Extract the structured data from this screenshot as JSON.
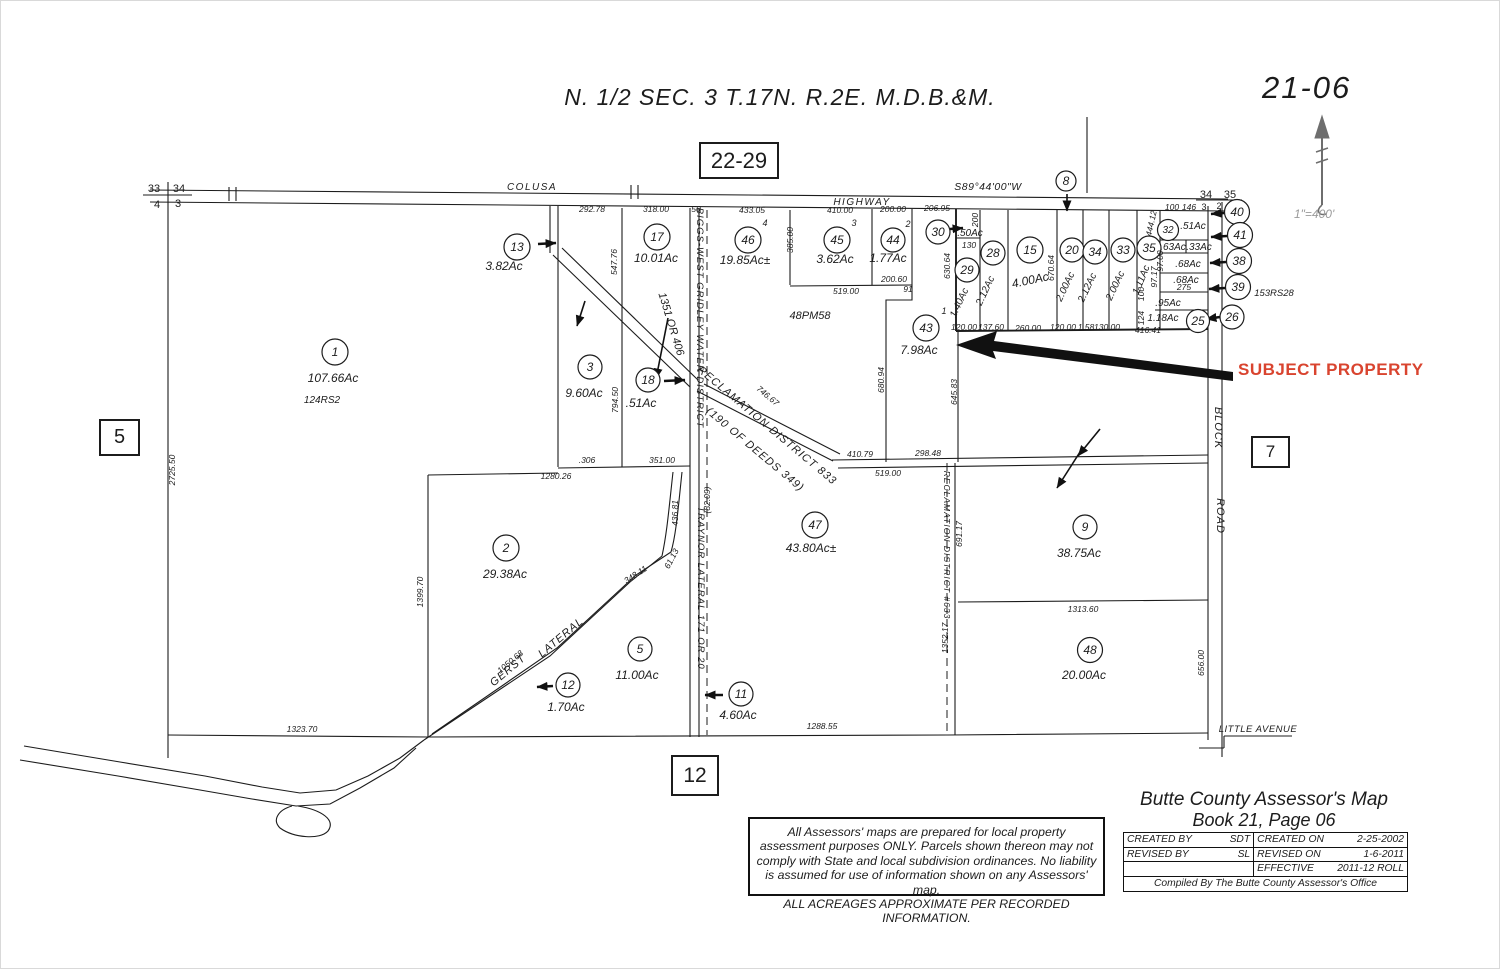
{
  "sheet": {
    "number": "21-06",
    "title": "N. 1/2 SEC. 3 T.17N. R.2E. M.D.B.&M.",
    "scale": "1\"=400'",
    "ref_top": "22-29",
    "ref_left": "5",
    "ref_right": "7",
    "ref_bottom": "12"
  },
  "corners": {
    "tl_a": "33",
    "tl_b": "34",
    "tl_c": "4",
    "tl_d": "3",
    "tr_a": "34",
    "tr_b": "35",
    "tr_c": "3",
    "tr_d": "2"
  },
  "roads": {
    "colusa": "COLUSA",
    "highway": "HIGHWAY",
    "bearing": "S89°44'00\"W",
    "marker_8": "8",
    "block": "BLOCK",
    "road": "ROAD",
    "little_avenue": "LITTLE AVENUE"
  },
  "waterways": {
    "biggs": "BIGGS-WEST GRIDLEY WATER DISTRICT",
    "biggs_ref": "1351 OR 406",
    "rd833": "RECLAMATION DISTRICT 833",
    "rd833_ref": "(190 OF DEEDS 349)",
    "traynor": "TRAYNOR LATERAL 171 OR 20",
    "rd633": "RECLAMATION DISTRICT #633",
    "gerst_1": "GERST",
    "gerst_2": "LATERAL"
  },
  "subject": {
    "label": "SUBJECT PROPERTY",
    "color": "#d9442f",
    "parcel": "43"
  },
  "notes": {
    "rs124": "124RS2",
    "pm48": "48PM58",
    "rs153": "153RS28"
  },
  "parcels": {
    "p1": {
      "num": "1",
      "ac": "107.66Ac"
    },
    "p2": {
      "num": "2",
      "ac": "29.38Ac"
    },
    "p3": {
      "num": "3",
      "ac": "9.60Ac"
    },
    "p5": {
      "num": "5",
      "ac": "11.00Ac"
    },
    "p9": {
      "num": "9",
      "ac": "38.75Ac"
    },
    "p11": {
      "num": "11",
      "ac": "4.60Ac"
    },
    "p12": {
      "num": "12",
      "ac": "1.70Ac"
    },
    "p13": {
      "num": "13",
      "ac": "3.82Ac"
    },
    "p15": {
      "num": "15",
      "ac": "4.00Ac"
    },
    "p17": {
      "num": "17",
      "ac": "10.01Ac"
    },
    "p18": {
      "num": "18",
      "ac": ".51Ac"
    },
    "p20": {
      "num": "20",
      "ac": "2.00Ac"
    },
    "p25": {
      "num": "25",
      "ac": "1.18Ac"
    },
    "p26": {
      "num": "26",
      "ac": ".95Ac"
    },
    "p28": {
      "num": "28",
      "ac": "2.12Ac"
    },
    "p29": {
      "num": "29",
      "ac": "1.40Ac"
    },
    "p30": {
      "num": "30",
      "ac": ".50Ac"
    },
    "p32": {
      "num": "32",
      "ac": ".51Ac"
    },
    "p33": {
      "num": "33",
      "ac": "2.00Ac"
    },
    "p34": {
      "num": "34",
      "ac": "2.12Ac"
    },
    "p35": {
      "num": "35",
      "ac": "1.11Ac"
    },
    "p38": {
      "num": "38"
    },
    "p39": {
      "num": "39"
    },
    "p40": {
      "num": "40"
    },
    "p41": {
      "num": "41"
    },
    "p43": {
      "num": "43",
      "ac": "7.98Ac",
      "lot": "1"
    },
    "p44": {
      "num": "44",
      "ac": "1.77Ac",
      "lot": "2"
    },
    "p45": {
      "num": "45",
      "ac": "3.62Ac",
      "lot": "3"
    },
    "p46": {
      "num": "46",
      "ac": "19.85Ac±",
      "lot": "4"
    },
    "p47": {
      "num": "47",
      "ac": "43.80Ac±"
    },
    "p48": {
      "num": "48",
      "ac": "20.00Ac"
    }
  },
  "extra_acreages": {
    "a63": ".63Ac",
    "a33": ".33Ac",
    "a68a": ".68Ac",
    "a68b": ".68Ac"
  },
  "dims": [
    "292.78",
    "318.00",
    "50",
    "433.05",
    "410.00",
    "200.00",
    "206.95",
    "547.76",
    "794.50",
    ".306",
    "351.00",
    "1280.26",
    "2725.50",
    "1399.70",
    "1323.70",
    "1288.55",
    "1050.68",
    "348.11",
    "61.13",
    "436.81",
    "(82.09)",
    "746.67",
    "410.79",
    "298.48",
    "519.00",
    "385.00",
    "519.00",
    "200.60",
    "91",
    "680.94",
    "645.83",
    "630.64",
    "670.64",
    "200",
    "130",
    "444.12",
    "100",
    "146",
    "97.17",
    "97.00",
    "100",
    "124",
    "120.00",
    "137.60",
    "260.00",
    "120.00",
    "1.58",
    "130.00",
    "416.41",
    "1313.60",
    "691.17",
    "1352.17",
    "656.00",
    "275"
  ],
  "title_block": {
    "title_line1": "Butte County Assessor's Map",
    "title_line2": "Book 21, Page 06",
    "created_by_label": "CREATED BY",
    "created_by": "SDT",
    "created_on_label": "CREATED ON",
    "created_on": "2-25-2002",
    "revised_by_label": "REVISED BY",
    "revised_by": "SL",
    "revised_on_label": "REVISED ON",
    "revised_on": "1-6-2011",
    "effective_label": "EFFECTIVE",
    "effective": "2011-12  ROLL",
    "compiled": "Compiled By The Butte County Assessor's Office"
  },
  "disclaimer": {
    "l1": "All Assessors' maps are prepared for local property",
    "l2": "assessment purposes ONLY.  Parcels shown thereon may not",
    "l3": "comply with State and local subdivision ordinances.  No liability",
    "l4": "is assumed for use of information shown on any Assessors' map.",
    "l5": "ALL ACREAGES APPROXIMATE PER RECORDED INFORMATION."
  }
}
